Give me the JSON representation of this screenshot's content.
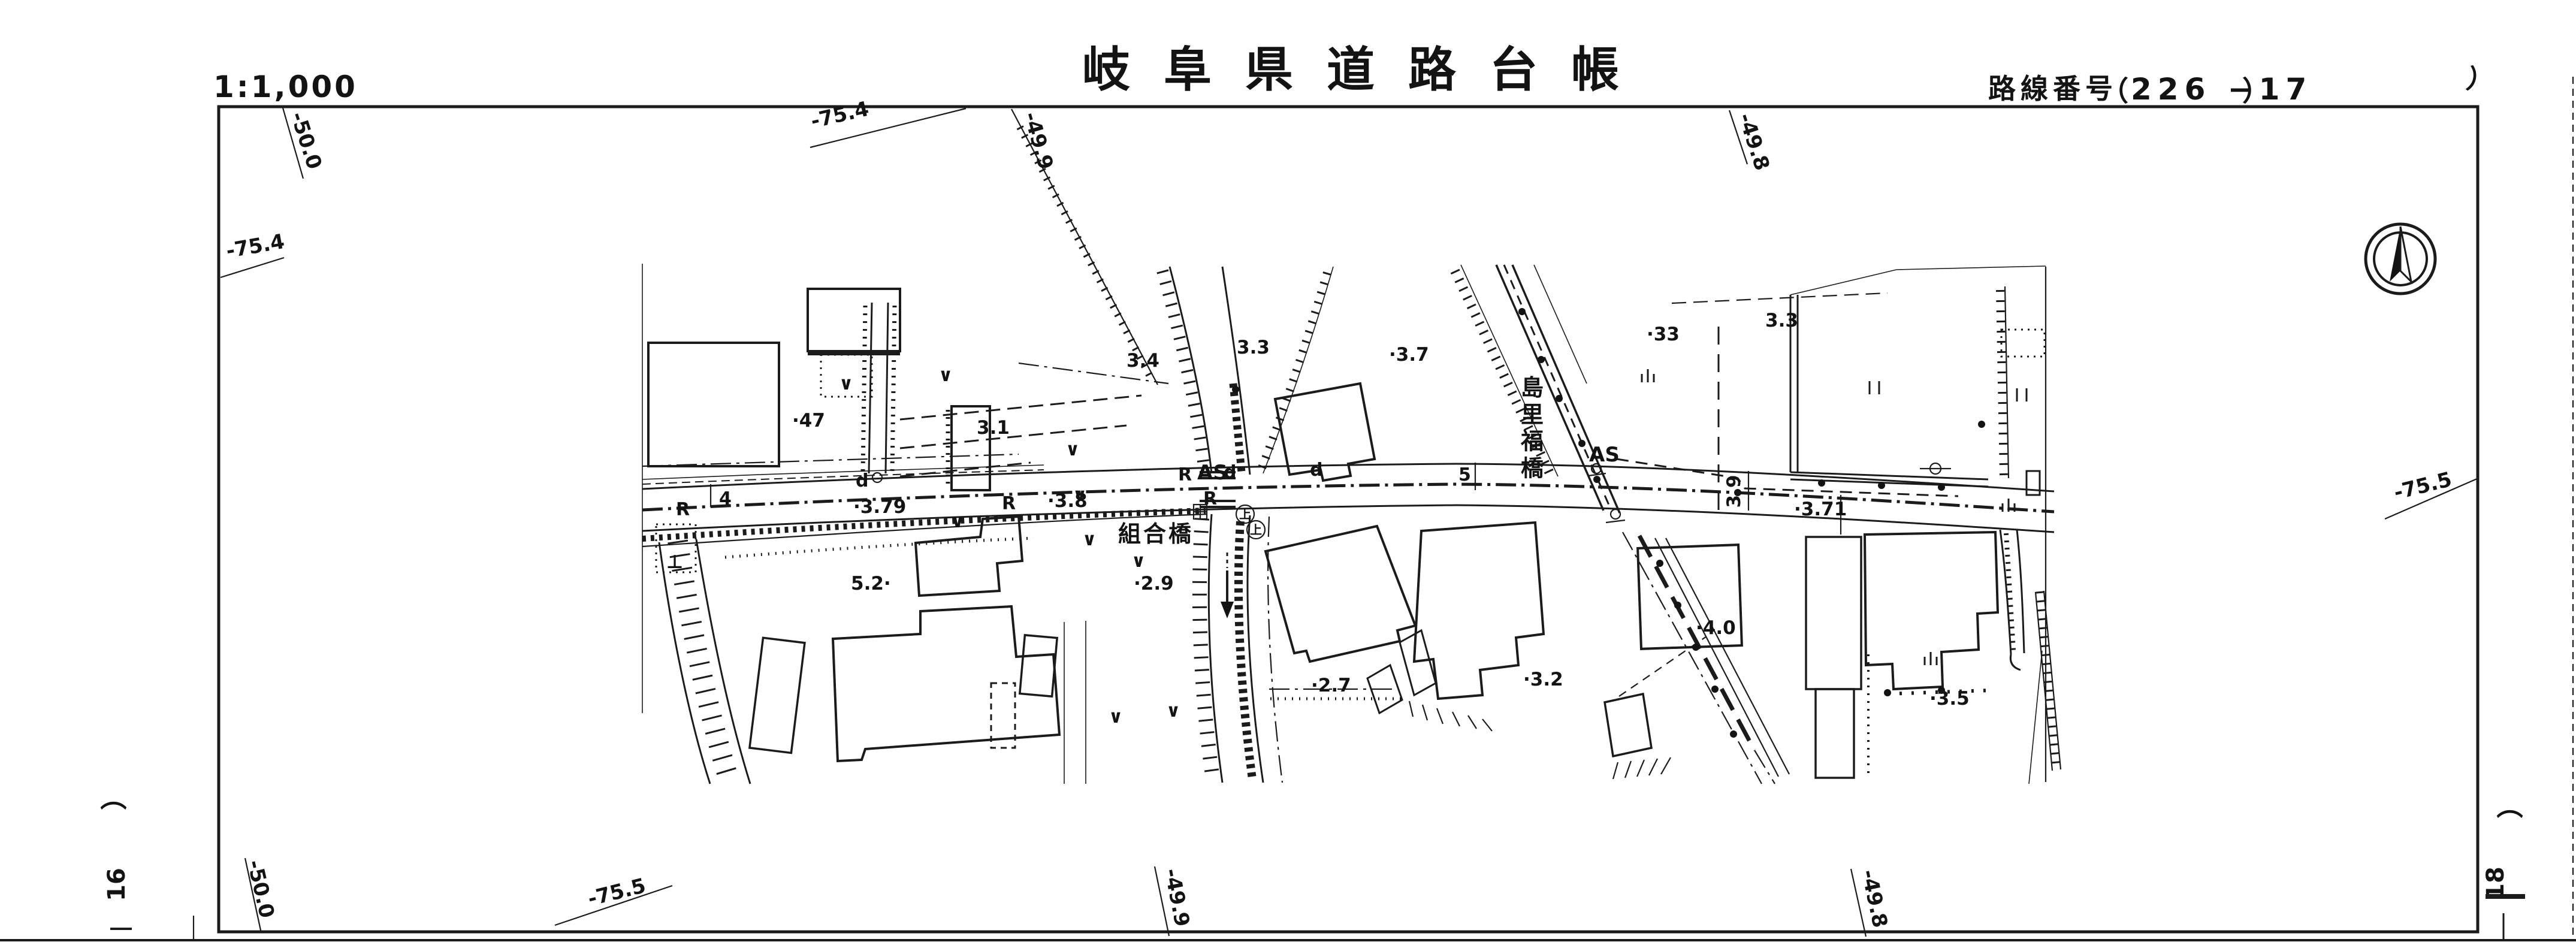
{
  "header": {
    "scale": "1:1,000",
    "title": "岐阜県道路台帳",
    "route_label": "路線番号",
    "route_open": "（",
    "route_number": "226 −17",
    "route_close": "）"
  },
  "margin": {
    "left_paren": "）",
    "left_sheet_number": "16",
    "right_paren_top": "）",
    "right_paren_bottom": "（",
    "right_sheet_number": "18"
  },
  "grid_labels": {
    "top_minus50_0": "-50.0",
    "top_minus75_4": "-75.4",
    "top_minus49_9": "-49.9",
    "top_minus49_8": "-49.8",
    "left_minus75_4": "-75.4",
    "right_minus75_5": "-75.5",
    "bottom_minus50_0": "-50.0",
    "bottom_minus75_5": "-75.5",
    "bottom_minus49_9": "-49.9",
    "bottom_minus49_8": "-49.8"
  },
  "map": {
    "bridge_kumiaibashi": "組合橋",
    "bridge_shimazatofukubashi": "島里福橋",
    "spot_elevations": {
      "e47": "·47",
      "e31": "3.1",
      "e34": "3.4",
      "e33a": "3.3",
      "e37": "·3.7",
      "e33b": "·33",
      "e33c": "3.3",
      "e52": "5.2·",
      "e29": "·2.9",
      "e27": "·2.7",
      "e32": "·3.2",
      "e40": "·4.0",
      "e35": "·3.5",
      "e371": "·3.71",
      "e379": "·3.79",
      "e38": "·3.8",
      "e39": "3.9"
    },
    "road_labels": {
      "r1": "R",
      "r2": "R",
      "r3": "R",
      "r4": "R",
      "as1": "AS",
      "as2": "AS",
      "d1": "d",
      "d2": "d",
      "d3": "d",
      "station4": "4",
      "station5": "5",
      "perp_symbol": "⊥"
    },
    "symbols": {
      "jou_label": "上",
      "jou_circles": [
        [
          2078,
          858
        ],
        [
          2096,
          884
        ]
      ],
      "v_marks": [
        [
          1412,
          650
        ],
        [
          1578,
          636
        ],
        [
          1790,
          760
        ],
        [
          1598,
          880
        ],
        [
          1802,
          836
        ],
        [
          1818,
          910
        ],
        [
          1900,
          946
        ],
        [
          1862,
          1206
        ],
        [
          1958,
          1196
        ]
      ],
      "pair_marks": [
        [
          3128,
          650
        ],
        [
          3374,
          662
        ]
      ],
      "tri_marks": [
        [
          2750,
          632
        ],
        [
          3222,
          1104
        ],
        [
          3352,
          848
        ]
      ],
      "dots": [
        [
          2540,
          520
        ],
        [
          2572,
          600
        ],
        [
          2602,
          665
        ],
        [
          2640,
          740
        ],
        [
          2665,
          800
        ],
        [
          2900,
          822
        ],
        [
          3307,
          708
        ],
        [
          3040,
          806
        ],
        [
          3140,
          810
        ],
        [
          3240,
          813
        ],
        [
          2770,
          940
        ],
        [
          2800,
          1010
        ],
        [
          2830,
          1080
        ],
        [
          2862,
          1150
        ],
        [
          2893,
          1225
        ],
        [
          2062,
          650
        ],
        [
          3150,
          1156
        ],
        [
          3240,
          1152
        ]
      ]
    }
  }
}
